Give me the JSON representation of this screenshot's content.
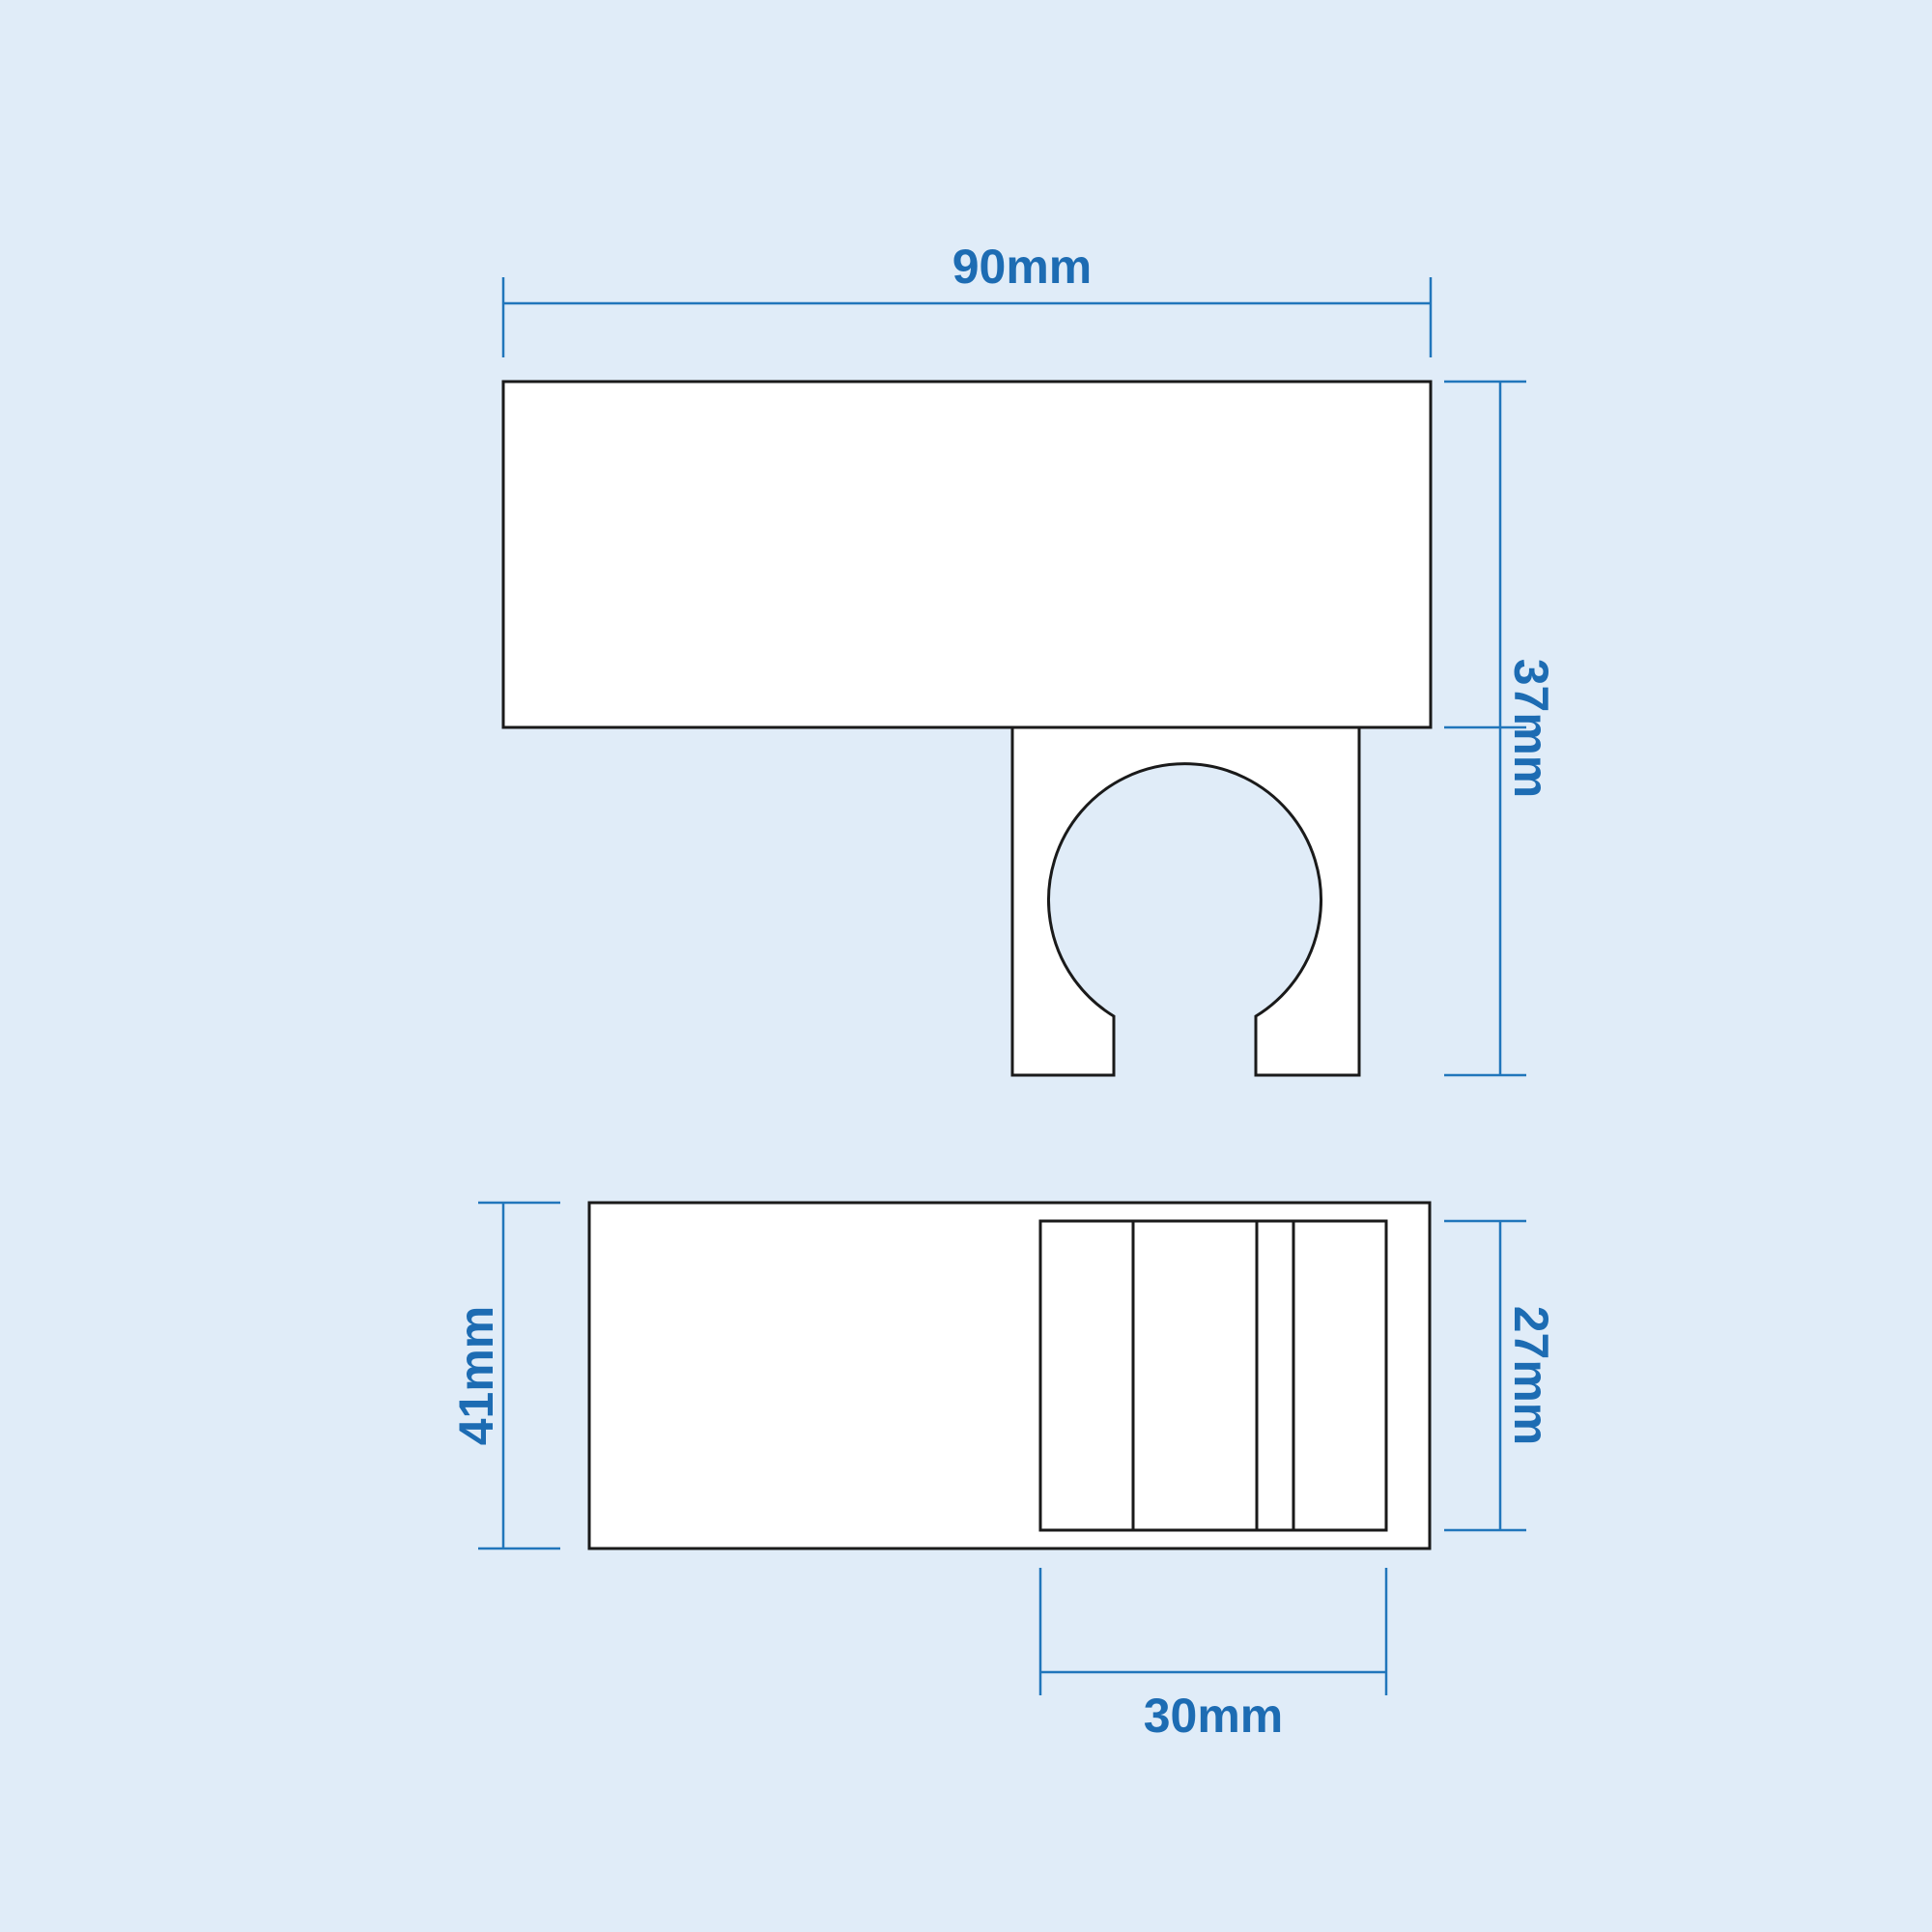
{
  "drawing": {
    "type": "technical-dimension-drawing",
    "views": {
      "top_view": {
        "dimensions": {
          "width_label": "90mm",
          "depth_label": "37mm"
        }
      },
      "bottom_view": {
        "dimensions": {
          "height_label": "41mm",
          "slot_height_label": "27mm",
          "slot_width_label": "30mm"
        }
      }
    },
    "colors": {
      "background": "#e0ecf8",
      "dimension_line": "#2176bb",
      "dimension_text": "#1d6cb3",
      "shape_outline": "#1a1a1a",
      "shape_fill": "#ffffff"
    }
  }
}
